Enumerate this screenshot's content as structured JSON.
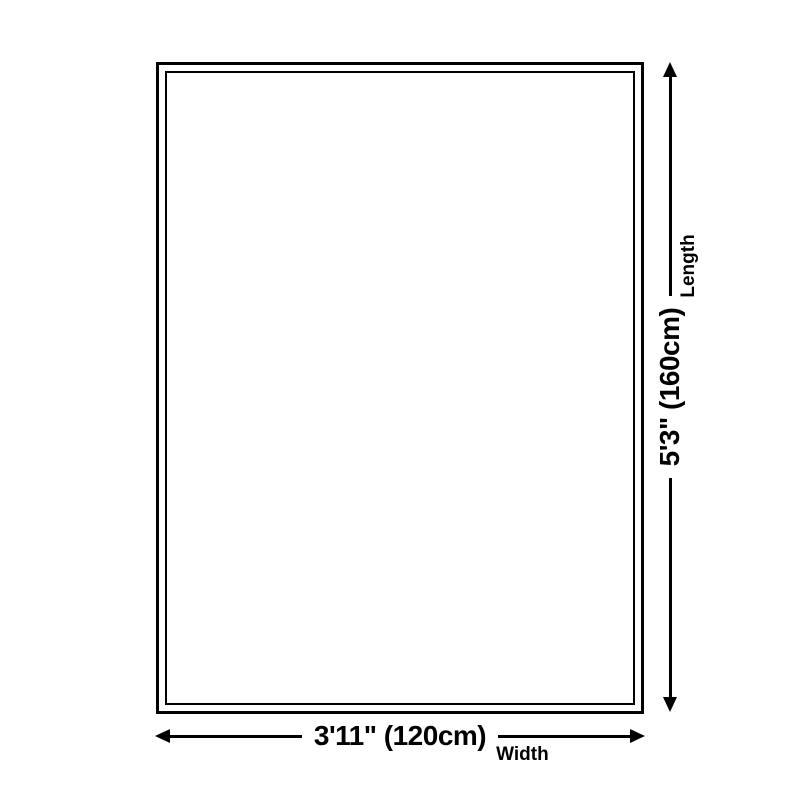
{
  "colors": {
    "background": "#ffffff",
    "line": "#000000",
    "text": "#000000"
  },
  "diagram": {
    "length_dimension": {
      "value": "5'3\" (160cm)",
      "label": "Length"
    },
    "width_dimension": {
      "value": "3'11\" (120cm)",
      "label": "Width"
    }
  }
}
